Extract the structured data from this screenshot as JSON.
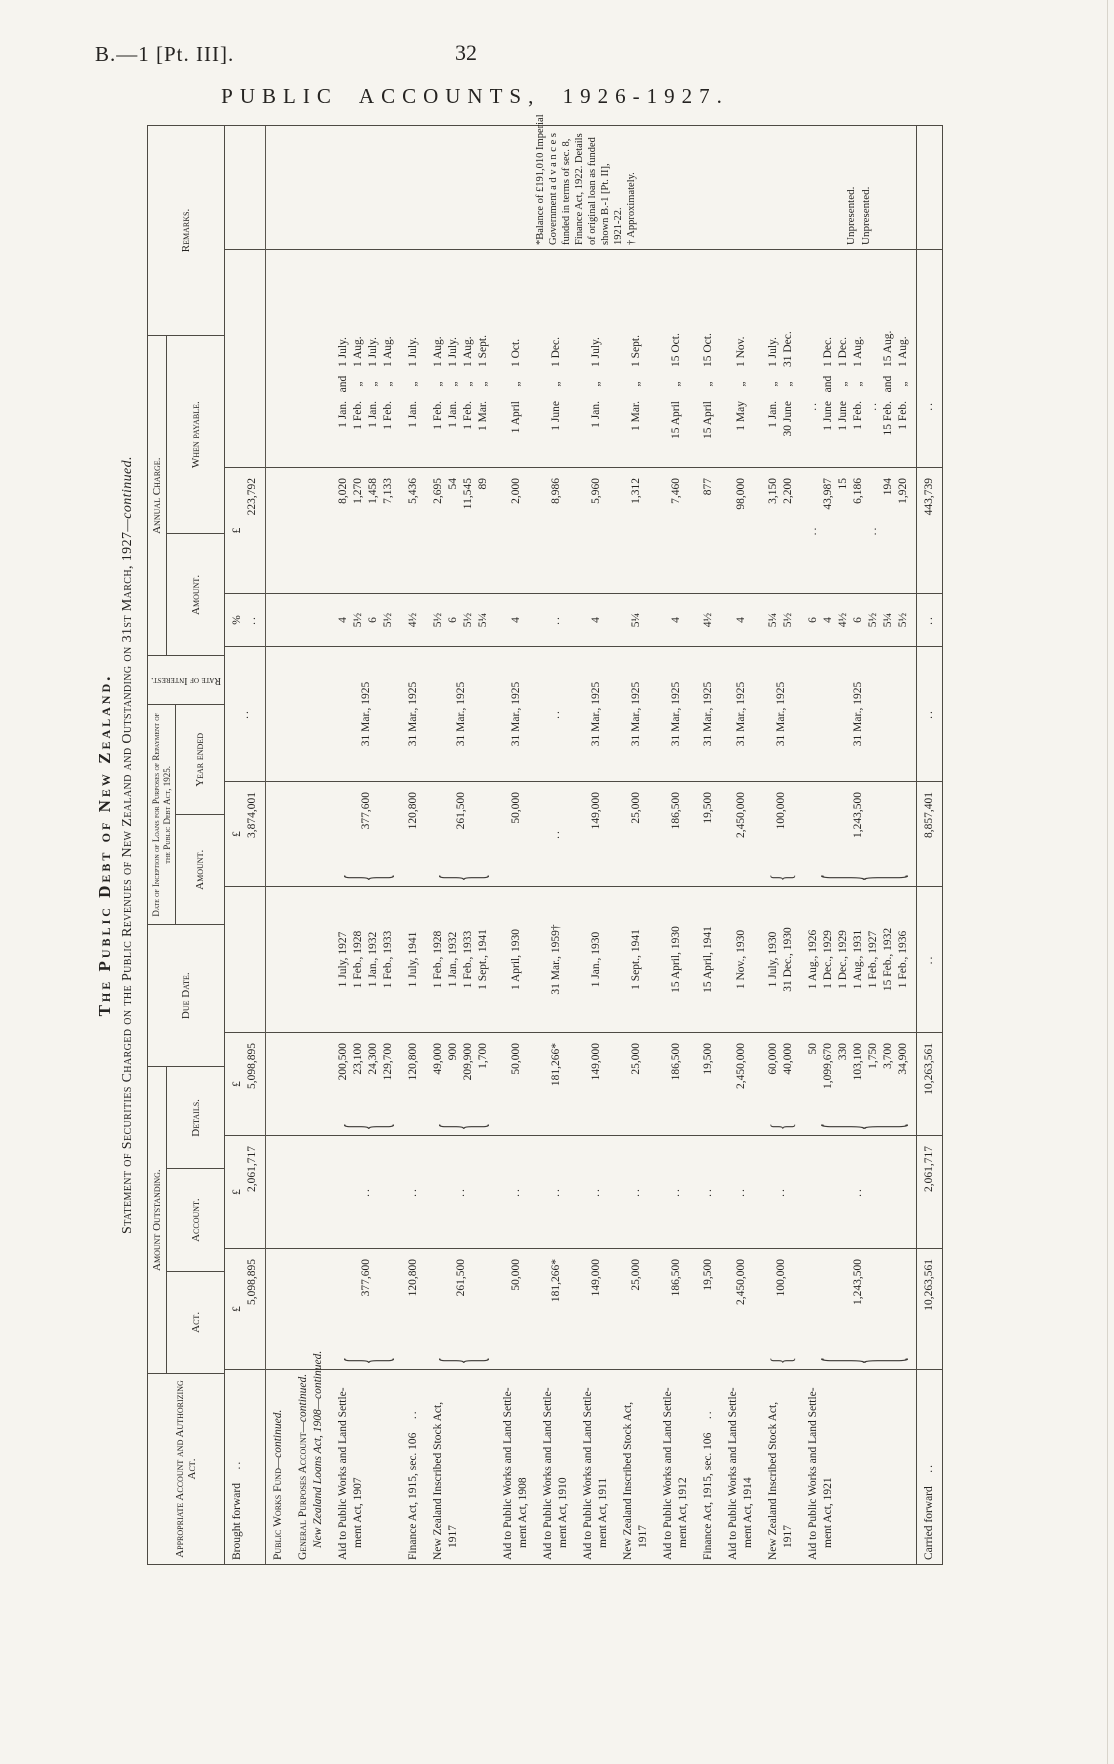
{
  "page": {
    "doc_ref": "B.—1 [Pt. III].",
    "page_number": "32",
    "title": "PUBLIC ACCOUNTS, 1926-1927."
  },
  "titles": {
    "main": "The Public Debt of New Zealand.",
    "sub": "Statement of Securities Charged on the Public Revenues of New Zealand and Outstanding on 31st March, 1927",
    "sub_cont": "—continued."
  },
  "headers": {
    "appropriate": "Appropriate Account and Authorizing Act.",
    "outstanding": "Amount Outstanding.",
    "act": "Act.",
    "account": "Account.",
    "details": "Details.",
    "due": "Due Date.",
    "inception": "Date of Inception of Loans for Purposes of Repayment of the Public Debt Act, 1925.",
    "inc_amount": "Amount.",
    "inc_year": "Year ended",
    "rate": "Rate of Interest.",
    "charge": "Annual Charge.",
    "ch_amount": "Amount.",
    "ch_payable": "When payable.",
    "remarks": "Remarks."
  },
  "table": {
    "rows": [
      {
        "kind": "data",
        "first": true,
        "label": [
          {
            "t": "Brought forward",
            "d": true
          }
        ],
        "act": [
          "£",
          "5,098,895"
        ],
        "account": [
          "£",
          "2,061,717"
        ],
        "details": [
          "£",
          "5,098,895"
        ],
        "due": [],
        "incept": [
          "£",
          "3,874,001"
        ],
        "year": [
          ".."
        ],
        "rate": [
          "%",
          ".."
        ],
        "annual": [
          "£",
          "223,792"
        ],
        "pay": []
      },
      {
        "kind": "section",
        "label": [
          {
            "t": "Public Works Fund",
            "c": "—continued.",
            "sc": true
          }
        ]
      },
      {
        "kind": "section",
        "label": [
          {
            "t": "General Purposes Account",
            "c": "—continued.",
            "sc": true
          },
          {
            "t": "New Zealand Loans Act, 1908",
            "c": "—continued.",
            "it": true
          }
        ]
      },
      {
        "kind": "data",
        "label": [
          {
            "t": "Aid to Public Works and Land Settle-"
          },
          {
            "t": "ment Act, 1907"
          }
        ],
        "act": [
          "377,600"
        ],
        "act_brace": true,
        "account": [
          ".."
        ],
        "details": [
          "200,500",
          "23,100",
          "24,300",
          "129,700"
        ],
        "details_brace": true,
        "due": [
          "1 July, 1927",
          "1 Feb., 1928",
          "1 Jan., 1932",
          "1 Feb., 1933"
        ],
        "incept": [
          "377,600"
        ],
        "incept_brace": true,
        "year": [
          "31 Mar., 1925"
        ],
        "rate": [
          "4",
          "5½",
          "6",
          "5½"
        ],
        "annual": [
          "8,020",
          "1,270",
          "1,458",
          "7,133"
        ],
        "pay": [
          [
            "1 Jan.",
            "and",
            "1 July."
          ],
          [
            "1 Feb.",
            "„",
            "1 Aug."
          ],
          [
            "1 Jan.",
            "„",
            "1 July."
          ],
          [
            "1 Feb.",
            "„",
            "1 Aug."
          ]
        ]
      },
      {
        "kind": "data",
        "label": [
          {
            "t": "Finance Act, 1915, sec. 106",
            "d": true
          }
        ],
        "act": [
          "120,800"
        ],
        "account": [
          ".."
        ],
        "details": [
          "120,800"
        ],
        "due": [
          "1 July, 1941"
        ],
        "incept": [
          "120,800"
        ],
        "year": [
          "31 Mar., 1925"
        ],
        "rate": [
          "4½"
        ],
        "annual": [
          "5,436"
        ],
        "pay": [
          [
            "1 Jan.",
            "„",
            "1 July."
          ]
        ]
      },
      {
        "kind": "data",
        "label": [
          {
            "t": "New Zealand Inscribed Stock Act,"
          },
          {
            "t": "1917"
          }
        ],
        "act": [
          "261,500"
        ],
        "act_brace": true,
        "account": [
          ".."
        ],
        "details": [
          "49,000",
          "900",
          "209,900",
          "1,700"
        ],
        "details_brace": true,
        "due": [
          "1 Feb., 1928",
          "1 Jan., 1932",
          "1 Feb., 1933",
          "1 Sept., 1941"
        ],
        "incept": [
          "261,500"
        ],
        "incept_brace": true,
        "year": [
          "31 Mar., 1925"
        ],
        "rate": [
          "5½",
          "6",
          "5½",
          "5¼"
        ],
        "annual": [
          "2,695",
          "54",
          "11,545",
          "89"
        ],
        "pay": [
          [
            "1 Feb.",
            "„",
            "1 Aug."
          ],
          [
            "1 Jan.",
            "„",
            "1 July."
          ],
          [
            "1 Feb.",
            "„",
            "1 Aug."
          ],
          [
            "1 Mar.",
            "„",
            "1 Sept."
          ]
        ]
      },
      {
        "kind": "data",
        "label": [
          {
            "t": "Aid to Public Works and Land Settle-"
          },
          {
            "t": "ment Act, 1908"
          }
        ],
        "act": [
          "50,000"
        ],
        "account": [
          ".."
        ],
        "details": [
          "50,000"
        ],
        "due": [
          "1 April, 1930"
        ],
        "incept": [
          "50,000"
        ],
        "year": [
          "31 Mar., 1925"
        ],
        "rate": [
          "4"
        ],
        "annual": [
          "2,000"
        ],
        "pay": [
          [
            "1 April",
            "„",
            "1 Oct."
          ]
        ]
      },
      {
        "kind": "data",
        "label": [
          {
            "t": "Aid to Public Works and Land Settle-"
          },
          {
            "t": "ment Act, 1910"
          }
        ],
        "act": [
          "181,266*"
        ],
        "account": [
          ".."
        ],
        "details": [
          "181,266*"
        ],
        "due": [
          "31 Mar., 1959†"
        ],
        "incept": [
          ".."
        ],
        "year": [
          ".."
        ],
        "rate": [
          ".."
        ],
        "annual": [
          "8,986"
        ],
        "pay": [
          [
            "1 June",
            "„",
            "1 Dec."
          ]
        ],
        "remarks": {
          "note": [
            "*Balance of £191,010 Imperial",
            "Government  a d v a n c e s",
            "funded in terms of sec. 8,",
            "Finance Act, 1922.  Details",
            "of original loan as funded",
            "shown  B.-1  [Pt.  II],",
            "1921-22.",
            "† Approximately."
          ]
        }
      },
      {
        "kind": "data",
        "label": [
          {
            "t": "Aid to Public Works and Land Settle-"
          },
          {
            "t": "ment Act, 1911"
          }
        ],
        "act": [
          "149,000"
        ],
        "account": [
          ".."
        ],
        "details": [
          "149,000"
        ],
        "due": [
          "1 Jan., 1930"
        ],
        "incept": [
          "149,000"
        ],
        "year": [
          "31 Mar., 1925"
        ],
        "rate": [
          "4"
        ],
        "annual": [
          "5,960"
        ],
        "pay": [
          [
            "1 Jan.",
            "„",
            "1 July."
          ]
        ]
      },
      {
        "kind": "data",
        "label": [
          {
            "t": "New Zealand Inscribed Stock Act,"
          },
          {
            "t": "1917"
          }
        ],
        "act": [
          "25,000"
        ],
        "account": [
          ".."
        ],
        "details": [
          "25,000"
        ],
        "due": [
          "1 Sept., 1941"
        ],
        "incept": [
          "25,000"
        ],
        "year": [
          "31 Mar., 1925"
        ],
        "rate": [
          "5¼"
        ],
        "annual": [
          "1,312"
        ],
        "pay": [
          [
            "1 Mar.",
            "„",
            "1 Sept."
          ]
        ]
      },
      {
        "kind": "data",
        "label": [
          {
            "t": "Aid to Public Works and Land Settle-"
          },
          {
            "t": "ment Act, 1912"
          }
        ],
        "act": [
          "186,500"
        ],
        "account": [
          ".."
        ],
        "details": [
          "186,500"
        ],
        "due": [
          "15 April, 1930"
        ],
        "incept": [
          "186,500"
        ],
        "year": [
          "31 Mar., 1925"
        ],
        "rate": [
          "4"
        ],
        "annual": [
          "7,460"
        ],
        "pay": [
          [
            "15 April",
            "„",
            "15 Oct."
          ]
        ]
      },
      {
        "kind": "data",
        "label": [
          {
            "t": "Finance Act, 1915, sec. 106",
            "d": true
          }
        ],
        "act": [
          "19,500"
        ],
        "account": [
          ".."
        ],
        "details": [
          "19,500"
        ],
        "due": [
          "15 April, 1941"
        ],
        "incept": [
          "19,500"
        ],
        "year": [
          "31 Mar., 1925"
        ],
        "rate": [
          "4½"
        ],
        "annual": [
          "877"
        ],
        "pay": [
          [
            "15 April",
            "„",
            "15 Oct."
          ]
        ]
      },
      {
        "kind": "data",
        "label": [
          {
            "t": "Aid to Public Works and Land Settle-"
          },
          {
            "t": "ment Act, 1914"
          }
        ],
        "act": [
          "2,450,000"
        ],
        "account": [
          ".."
        ],
        "details": [
          "2,450,000"
        ],
        "due": [
          "1 Nov., 1930"
        ],
        "incept": [
          "2,450,000"
        ],
        "year": [
          "31 Mar., 1925"
        ],
        "rate": [
          "4"
        ],
        "annual": [
          "98,000"
        ],
        "pay": [
          [
            "1 May",
            "„",
            "1 Nov."
          ]
        ]
      },
      {
        "kind": "data",
        "label": [
          {
            "t": "New Zealand Inscribed Stock Act,"
          },
          {
            "t": "1917"
          }
        ],
        "act": [
          "100,000"
        ],
        "act_brace": true,
        "account": [
          ".."
        ],
        "details": [
          "60,000",
          "40,000"
        ],
        "details_brace": true,
        "due": [
          "1 July, 1930",
          "31 Dec., 1930"
        ],
        "incept": [
          "100,000"
        ],
        "incept_brace": true,
        "year": [
          "31 Mar., 1925"
        ],
        "rate": [
          "5¼",
          "5½"
        ],
        "annual": [
          "3,150",
          "2,200"
        ],
        "pay": [
          [
            "1 Jan.",
            "„",
            "1 July."
          ],
          [
            "30 June",
            "„",
            "31 Dec."
          ]
        ]
      },
      {
        "kind": "data",
        "label": [
          {
            "t": "Aid to Public Works and Land Settle-"
          },
          {
            "t": "ment Act, 1921"
          }
        ],
        "act": [
          "1,243,500"
        ],
        "act_brace": true,
        "account": [
          ".."
        ],
        "details": [
          "50",
          "1,099,670",
          "330",
          "103,100",
          "1,750",
          "3,700",
          "34,900"
        ],
        "details_brace": true,
        "due": [
          "1 Aug., 1926",
          "1 Dec., 1929",
          "1 Dec., 1929",
          "1 Aug., 1931",
          "1 Feb., 1927",
          "15 Feb., 1932",
          "1 Feb., 1936"
        ],
        "incept": [
          "1,243,500"
        ],
        "incept_brace": true,
        "year": [
          "31 Mar., 1925"
        ],
        "rate": [
          "6",
          "4",
          "4½",
          "6",
          "5½",
          "5¼",
          "5½"
        ],
        "annual": [
          "..",
          "43,987",
          "15",
          "6,186",
          "..",
          "194",
          "1,920"
        ],
        "pay": [
          [
            "..",
            "",
            ""
          ],
          [
            "1 June",
            "and",
            "1 Dec."
          ],
          [
            "1 June",
            "„",
            "1 Dec."
          ],
          [
            "1 Feb.",
            "„",
            "1 Aug."
          ],
          [
            "..",
            "",
            ""
          ],
          [
            "15 Feb.",
            "and",
            "15 Aug."
          ],
          [
            "1 Feb.",
            "„",
            "1 Aug."
          ]
        ],
        "remarks": {
          "lines": [
            "Unpresented.",
            "",
            "",
            "",
            "Unpresented.",
            "",
            ""
          ]
        }
      },
      {
        "kind": "total",
        "label": [
          {
            "t": "Carried forward",
            "d": true
          }
        ],
        "act": [
          "10,263,561"
        ],
        "account": [
          "2,061,717"
        ],
        "details": [
          "10,263,561"
        ],
        "due": [
          ".."
        ],
        "incept": [
          "8,857,401"
        ],
        "year": [
          ".."
        ],
        "rate": [
          ".."
        ],
        "annual": [
          "443,739"
        ],
        "pay": [
          [
            "..",
            "",
            ""
          ]
        ]
      }
    ]
  }
}
